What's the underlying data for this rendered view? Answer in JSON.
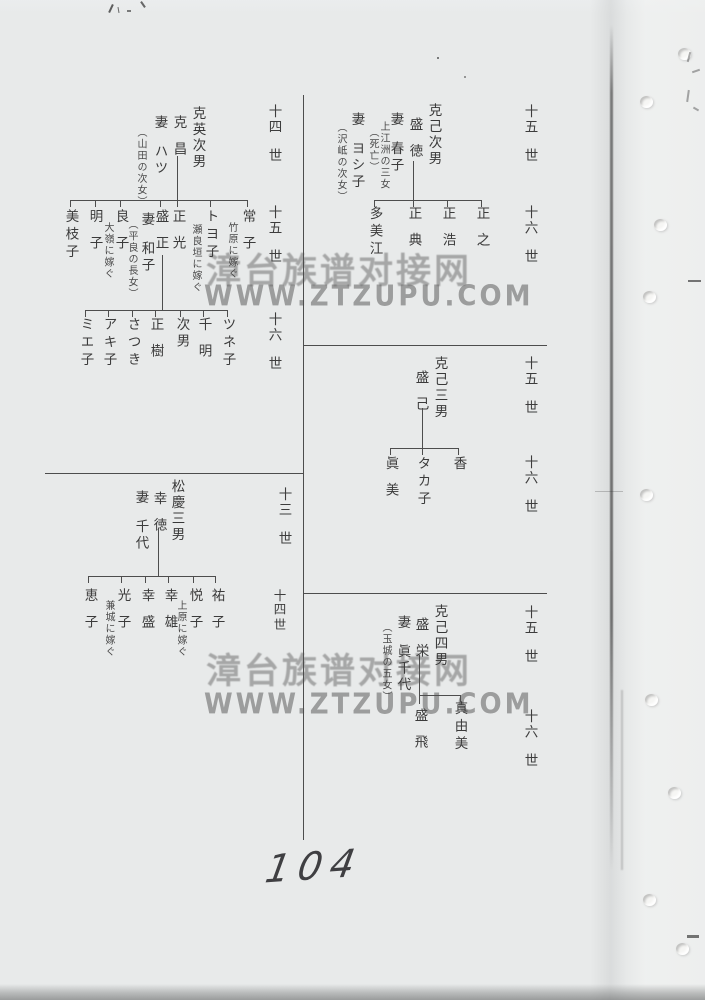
{
  "watermark": {
    "cn": "漳台族谱对接网",
    "url": "WWW.ZTZUPU.COM"
  },
  "handwriting": {
    "page_number": "104"
  },
  "markers": {
    "l14a": {
      "num": "十四",
      "sei": "世"
    },
    "l15a": {
      "num": "十五",
      "sei": "世"
    },
    "l16a": {
      "num": "十六",
      "sei": "世"
    },
    "l13": {
      "num": "十三",
      "sei": "世"
    },
    "l14b": {
      "num": "十四",
      "sei": "世"
    },
    "r15a": {
      "num": "十五",
      "sei": "世"
    },
    "r16a": {
      "num": "十六",
      "sei": "世"
    },
    "r15b": {
      "num": "十五",
      "sei": "世"
    },
    "r16b": {
      "num": "十六",
      "sei": "世"
    },
    "r15c": {
      "num": "十五",
      "sei": "世"
    },
    "r16c": {
      "num": "十六",
      "sei": "世"
    }
  },
  "sectionA": {
    "title": "克英次男",
    "father": "克昌",
    "wife": {
      "rel": "妻",
      "name": "ハツ",
      "note": "︵山田の次女︶"
    },
    "children": [
      {
        "name": "常子",
        "note": "竹原に嫁ぐ"
      },
      {
        "name": "トヨ子",
        "note": "瀬良垣に嫁ぐ"
      },
      {
        "name": "正光"
      },
      {
        "name": "盛正",
        "wife_rel": "妻",
        "wife_name": "和子",
        "wife_note": "︵平良の長女︶"
      },
      {
        "name": "良子",
        "note": "大嶺に嫁ぐ"
      },
      {
        "name": "明子"
      },
      {
        "name": "美枝子"
      }
    ],
    "grandchildren": [
      {
        "name": "ツネ子"
      },
      {
        "name": "千明"
      },
      {
        "name": "次男"
      },
      {
        "name": "正樹"
      },
      {
        "name": "さつき"
      },
      {
        "name": "アキ子"
      },
      {
        "name": "ミエ子"
      }
    ]
  },
  "sectionB": {
    "title": "克己次男",
    "father": "盛徳",
    "wife1": {
      "rel": "妻",
      "name": "春子",
      "note1": "上江洲の三女",
      "note2": "︵死亡︶"
    },
    "wife2": {
      "rel": "妻",
      "name": "ヨシ子",
      "note": "︵沢岻の次女︶"
    },
    "children": [
      {
        "name": "正之"
      },
      {
        "name": "正浩"
      },
      {
        "name": "正典"
      },
      {
        "name": "多美江"
      }
    ]
  },
  "sectionC": {
    "title": "克己三男",
    "father": "盛己",
    "children": [
      {
        "name": "香"
      },
      {
        "name": "タカ子"
      },
      {
        "name": "眞美"
      }
    ]
  },
  "sectionD": {
    "title": "松慶三男",
    "father": "幸徳",
    "wife": {
      "rel": "妻",
      "name": "千代"
    },
    "children": [
      {
        "name": "祐子"
      },
      {
        "name": "悦子",
        "note": "上原に嫁ぐ"
      },
      {
        "name": "幸雄"
      },
      {
        "name": "幸盛"
      },
      {
        "name": "光子",
        "note": "兼城に嫁ぐ"
      },
      {
        "name": "恵子"
      }
    ]
  },
  "sectionE": {
    "title": "克己四男",
    "father": "盛栄",
    "wife": {
      "rel": "妻",
      "name": "眞千代",
      "note": "︵玉城の五女︶"
    },
    "children": [
      {
        "name": "真由美"
      },
      {
        "name": "盛飛"
      }
    ]
  }
}
